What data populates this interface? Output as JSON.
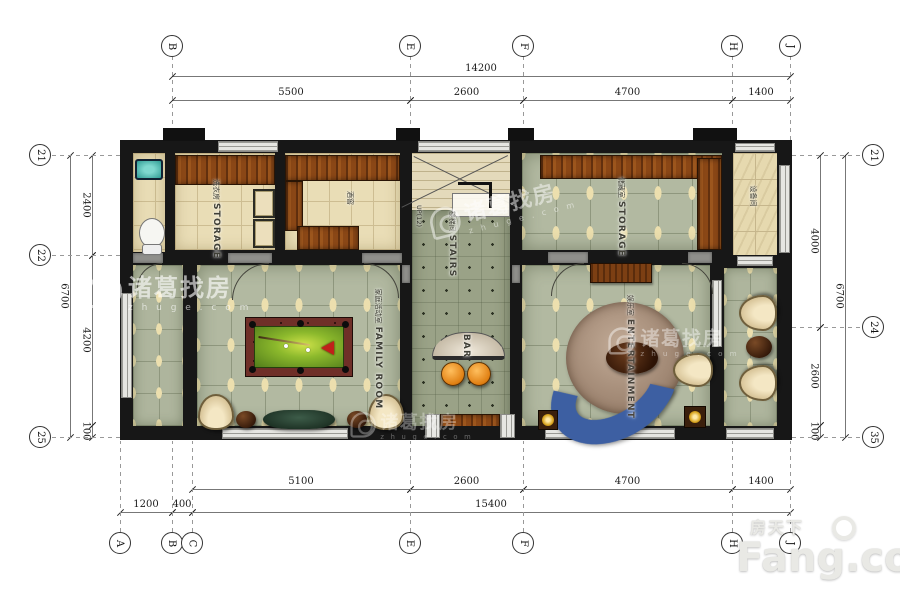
{
  "drawing": {
    "rooms": {
      "laundry": {
        "cn": "洗衣房",
        "en": "STORAGE"
      },
      "wine": {
        "cn": "酒窖",
        "en": ""
      },
      "stairs": {
        "cn": "楼梯间",
        "en": "STAIRS"
      },
      "stairs_up": "UP(12)",
      "bar": {
        "cn": "",
        "en": "BAR"
      },
      "family": {
        "cn": "家庭活动室",
        "en": "FAMILY ROOM"
      },
      "storage": {
        "cn": "储藏室",
        "en": "STORAGE"
      },
      "equipment": {
        "cn": "设备间",
        "en": ""
      },
      "entertainment": {
        "cn": "娱乐室",
        "en": "ENTERTAINMENT"
      }
    },
    "grid_bubbles": {
      "top": [
        {
          "label": "B",
          "x": 172
        },
        {
          "label": "E",
          "x": 410
        },
        {
          "label": "F",
          "x": 523
        },
        {
          "label": "H",
          "x": 732
        },
        {
          "label": "J",
          "x": 790
        }
      ],
      "bottom": [
        {
          "label": "A",
          "x": 120
        },
        {
          "label": "B",
          "x": 172
        },
        {
          "label": "C",
          "x": 192
        },
        {
          "label": "E",
          "x": 410
        },
        {
          "label": "F",
          "x": 523
        },
        {
          "label": "H",
          "x": 732
        },
        {
          "label": "J",
          "x": 790
        }
      ],
      "left": [
        {
          "label": "21",
          "y": 155
        },
        {
          "label": "22",
          "y": 255
        },
        {
          "label": "25",
          "y": 437
        }
      ],
      "right": [
        {
          "label": "21",
          "y": 155
        },
        {
          "label": "24",
          "y": 327
        },
        {
          "label": "35",
          "y": 437
        }
      ]
    },
    "dim_rows": [
      {
        "dir": "h",
        "pos": 76,
        "segs": [
          {
            "label": "14200",
            "from": 172,
            "to": 790
          }
        ]
      },
      {
        "dir": "h",
        "pos": 100,
        "segs": [
          {
            "label": "5500",
            "from": 172,
            "to": 410
          },
          {
            "label": "2600",
            "from": 410,
            "to": 523
          },
          {
            "label": "4700",
            "from": 523,
            "to": 732
          },
          {
            "label": "1400",
            "from": 732,
            "to": 790
          }
        ]
      },
      {
        "dir": "h",
        "pos": 489,
        "segs": [
          {
            "label": "5100",
            "from": 192,
            "to": 410
          },
          {
            "label": "2600",
            "from": 410,
            "to": 523
          },
          {
            "label": "4700",
            "from": 523,
            "to": 732
          },
          {
            "label": "1400",
            "from": 732,
            "to": 790
          }
        ]
      },
      {
        "dir": "h",
        "pos": 512,
        "segs": [
          {
            "label": "1200",
            "from": 120,
            "to": 172
          },
          {
            "label": "400",
            "from": 172,
            "to": 192
          },
          {
            "label": "15400",
            "from": 192,
            "to": 790
          }
        ]
      },
      {
        "dir": "v",
        "pos": 70,
        "segs": [
          {
            "label": "6700",
            "from": 155,
            "to": 437
          }
        ]
      },
      {
        "dir": "v",
        "pos": 92,
        "segs": [
          {
            "label": "2400",
            "from": 155,
            "to": 255
          },
          {
            "label": "4200",
            "from": 255,
            "to": 425
          },
          {
            "label": "100",
            "from": 425,
            "to": 437
          }
        ]
      },
      {
        "dir": "v",
        "pos": 820,
        "segs": [
          {
            "label": "4000",
            "from": 155,
            "to": 327
          },
          {
            "label": "2600",
            "from": 327,
            "to": 425
          },
          {
            "label": "100",
            "from": 425,
            "to": 437
          }
        ]
      },
      {
        "dir": "v",
        "pos": 845,
        "segs": [
          {
            "label": "6700",
            "from": 155,
            "to": 437
          }
        ]
      }
    ]
  },
  "watermark": {
    "cn": "诸葛找房",
    "en": "z h u g e . c o m"
  },
  "brand": {
    "cn": "房天下",
    "en": "Fang.com"
  },
  "colors": {
    "wall": "#171717",
    "wood": "#8a4716",
    "felt": "#8cb92c",
    "sofa": "#3d5fa2",
    "stool": "#e07f12",
    "sink": "#2f9b93",
    "tile_accent": "#ecdfae"
  }
}
